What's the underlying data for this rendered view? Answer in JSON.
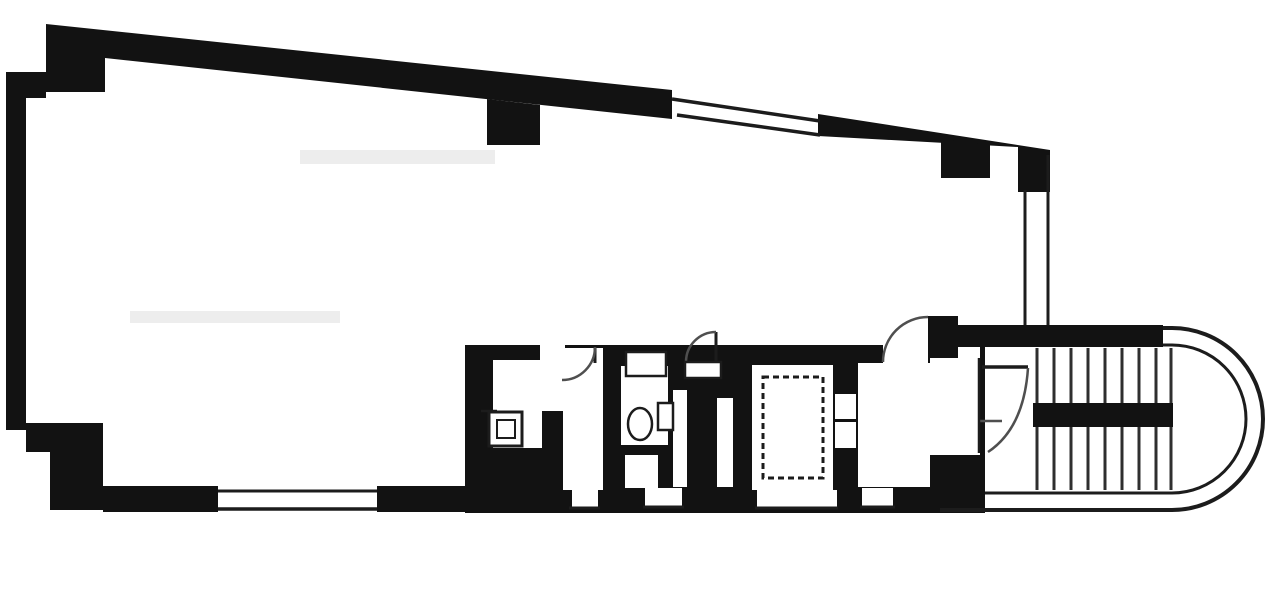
{
  "meta": {
    "description": "black-and-white architectural floor plan, single floor with large tapered office room, service core (pantry, WC, pipe shafts), elevator shaft and stairwell with rounded end",
    "canvas": {
      "width": 1280,
      "height": 595
    }
  },
  "colors": {
    "paper": "#ffffff",
    "ink": "#121212",
    "thin": "#1c1c1c",
    "step": "#2f2f2f",
    "arc": "#4f4f4f",
    "smudge": "#ededed"
  },
  "stairs": {
    "step_xs": [
      1037,
      1054,
      1071,
      1088,
      1105,
      1122,
      1139,
      1156,
      1171
    ],
    "step_y1": 348,
    "step_y2": 490,
    "step_width": 3
  },
  "shapes": [
    {
      "t": "rect",
      "name": "page-background",
      "x": 0,
      "y": 0,
      "w": 1280,
      "h": 595,
      "fill": "paper"
    },
    {
      "t": "rect",
      "name": "faint-smudge-upper",
      "x": 300,
      "y": 150,
      "w": 195,
      "h": 14,
      "fill": "smudge"
    },
    {
      "t": "rect",
      "name": "faint-smudge-lower",
      "x": 130,
      "y": 311,
      "w": 210,
      "h": 12,
      "fill": "smudge"
    },
    {
      "t": "poly",
      "name": "top-wall-left",
      "pts": [
        [
          46,
          24
        ],
        [
          672,
          90
        ],
        [
          672,
          119
        ],
        [
          105,
          58
        ],
        [
          105,
          92
        ],
        [
          46,
          92
        ]
      ],
      "fill": "ink"
    },
    {
      "t": "poly",
      "name": "top-wall-pier-left",
      "pts": [
        [
          487,
          99
        ],
        [
          540,
          105
        ],
        [
          540,
          145
        ],
        [
          487,
          145
        ]
      ],
      "fill": "ink"
    },
    {
      "t": "poly",
      "name": "top-wall-right",
      "pts": [
        [
          818,
          114
        ],
        [
          1050,
          150
        ],
        [
          1050,
          192
        ],
        [
          1018,
          192
        ],
        [
          1018,
          147
        ],
        [
          818,
          136
        ]
      ],
      "fill": "ink"
    },
    {
      "t": "poly",
      "name": "top-wall-pier-right",
      "pts": [
        [
          941,
          139
        ],
        [
          990,
          145
        ],
        [
          990,
          178
        ],
        [
          941,
          178
        ]
      ],
      "fill": "ink"
    },
    {
      "t": "poly",
      "name": "left-wall",
      "pts": [
        [
          6,
          72
        ],
        [
          26,
          72
        ],
        [
          26,
          430
        ],
        [
          6,
          430
        ]
      ],
      "fill": "ink"
    },
    {
      "t": "poly",
      "name": "left-wall-top-step",
      "pts": [
        [
          26,
          72
        ],
        [
          46,
          72
        ],
        [
          46,
          98
        ],
        [
          26,
          98
        ]
      ],
      "fill": "ink"
    },
    {
      "t": "poly",
      "name": "bottom-left-corner-step-a",
      "pts": [
        [
          26,
          423
        ],
        [
          103,
          423
        ],
        [
          103,
          452
        ],
        [
          26,
          452
        ]
      ],
      "fill": "ink"
    },
    {
      "t": "poly",
      "name": "bottom-left-corner-step-b",
      "pts": [
        [
          50,
          452
        ],
        [
          103,
          452
        ],
        [
          103,
          510
        ],
        [
          50,
          510
        ]
      ],
      "fill": "ink"
    },
    {
      "t": "poly",
      "name": "bottom-wall-left",
      "pts": [
        [
          103,
          486
        ],
        [
          218,
          486
        ],
        [
          218,
          512
        ],
        [
          103,
          512
        ]
      ],
      "fill": "ink"
    },
    {
      "t": "poly",
      "name": "bottom-wall-mid",
      "pts": [
        [
          377,
          486
        ],
        [
          466,
          486
        ],
        [
          466,
          512
        ],
        [
          377,
          512
        ]
      ],
      "fill": "ink"
    },
    {
      "t": "poly",
      "name": "service-core-walls",
      "pts": [
        [
          465,
          345
        ],
        [
          985,
          345
        ],
        [
          985,
          513
        ],
        [
          465,
          513
        ]
      ],
      "fill": "ink"
    },
    {
      "t": "poly",
      "name": "stairwell-top-wall",
      "pts": [
        [
          958,
          325
        ],
        [
          1163,
          325
        ],
        [
          1163,
          347
        ],
        [
          958,
          347
        ]
      ],
      "fill": "ink"
    },
    {
      "t": "poly",
      "name": "hall-door-stub-wall",
      "pts": [
        [
          928,
          316
        ],
        [
          958,
          316
        ],
        [
          958,
          358
        ],
        [
          928,
          358
        ]
      ],
      "fill": "ink"
    },
    {
      "t": "rect",
      "name": "pantry-room",
      "x": 493,
      "y": 360,
      "w": 49,
      "h": 88,
      "fill": "paper"
    },
    {
      "t": "rect",
      "name": "pantry-passage",
      "x": 540,
      "y": 345,
      "w": 25,
      "h": 66,
      "fill": "paper"
    },
    {
      "t": "rect",
      "name": "mid-room",
      "x": 563,
      "y": 348,
      "w": 40,
      "h": 142,
      "fill": "paper"
    },
    {
      "t": "rect",
      "name": "mid-room-window-notch",
      "x": 572,
      "y": 488,
      "w": 26,
      "h": 19,
      "fill": "paper"
    },
    {
      "t": "rect",
      "name": "wc-room",
      "x": 621,
      "y": 366,
      "w": 47,
      "h": 79,
      "fill": "paper"
    },
    {
      "t": "rect",
      "name": "wc-alcove",
      "x": 625,
      "y": 455,
      "w": 33,
      "h": 33,
      "fill": "paper"
    },
    {
      "t": "rect",
      "name": "wc-window-notch",
      "x": 645,
      "y": 488,
      "w": 37,
      "h": 19,
      "fill": "paper"
    },
    {
      "t": "rect",
      "name": "pipe-shaft-a",
      "x": 673,
      "y": 390,
      "w": 14,
      "h": 97,
      "fill": "paper"
    },
    {
      "t": "rect",
      "name": "pipe-shaft-b",
      "x": 717,
      "y": 398,
      "w": 16,
      "h": 89,
      "fill": "paper"
    },
    {
      "t": "rect",
      "name": "elevator-shaft",
      "x": 752,
      "y": 365,
      "w": 81,
      "h": 125,
      "fill": "paper"
    },
    {
      "t": "rect",
      "name": "under-shaft-window",
      "x": 757,
      "y": 490,
      "w": 80,
      "h": 17,
      "fill": "paper"
    },
    {
      "t": "rect",
      "name": "elevator-door-notch-a",
      "x": 835,
      "y": 394,
      "w": 21,
      "h": 25,
      "fill": "paper"
    },
    {
      "t": "rect",
      "name": "elevator-door-notch-b",
      "x": 835,
      "y": 422,
      "w": 21,
      "h": 26,
      "fill": "paper"
    },
    {
      "t": "rect",
      "name": "elevator-hall",
      "x": 858,
      "y": 363,
      "w": 72,
      "h": 124,
      "fill": "paper"
    },
    {
      "t": "rect",
      "name": "hall-door-opening",
      "x": 883,
      "y": 345,
      "w": 45,
      "h": 19,
      "fill": "paper"
    },
    {
      "t": "rect",
      "name": "hall-window-notch",
      "x": 862,
      "y": 488,
      "w": 31,
      "h": 18,
      "fill": "paper"
    },
    {
      "t": "rect",
      "name": "stair-vestibule",
      "x": 930,
      "y": 358,
      "w": 50,
      "h": 97,
      "fill": "paper"
    },
    {
      "t": "rect",
      "name": "stair-vestibule-notch",
      "x": 958,
      "y": 347,
      "w": 22,
      "h": 12,
      "fill": "paper"
    },
    {
      "t": "steps",
      "name": "stair-treads"
    },
    {
      "t": "poly",
      "name": "stair-landing-bar",
      "pts": [
        [
          1033,
          403
        ],
        [
          1173,
          403
        ],
        [
          1173,
          427
        ],
        [
          1033,
          427
        ]
      ],
      "fill": "ink"
    },
    {
      "t": "line",
      "name": "top-window-outer-edge",
      "x1": 672,
      "y1": 99,
      "x2": 820,
      "y2": 121,
      "stroke": "thin",
      "w": 3.5
    },
    {
      "t": "line",
      "name": "top-window-inner-edge",
      "x1": 677,
      "y1": 115,
      "x2": 820,
      "y2": 135,
      "stroke": "thin",
      "w": 3.5
    },
    {
      "t": "line",
      "name": "bottom-window-inner-edge",
      "x1": 218,
      "y1": 491,
      "x2": 377,
      "y2": 491,
      "stroke": "thin",
      "w": 3
    },
    {
      "t": "line",
      "name": "bottom-window-outer-edge",
      "x1": 218,
      "y1": 509,
      "x2": 377,
      "y2": 509,
      "stroke": "thin",
      "w": 3.5
    },
    {
      "t": "line",
      "name": "east-glass-wall-inner",
      "x1": 1025,
      "y1": 190,
      "x2": 1025,
      "y2": 325,
      "stroke": "thin",
      "w": 3
    },
    {
      "t": "line",
      "name": "east-glass-wall-outer",
      "x1": 1048,
      "y1": 155,
      "x2": 1048,
      "y2": 325,
      "stroke": "thin",
      "w": 3
    },
    {
      "t": "line",
      "name": "under-shaft-sill",
      "x1": 755,
      "y1": 508,
      "x2": 838,
      "y2": 508,
      "stroke": "thin",
      "w": 3
    },
    {
      "t": "line",
      "name": "hall-sill",
      "x1": 860,
      "y1": 507,
      "x2": 895,
      "y2": 507,
      "stroke": "thin",
      "w": 3
    },
    {
      "t": "line",
      "name": "mid-room-sill",
      "x1": 569,
      "y1": 508,
      "x2": 600,
      "y2": 508,
      "stroke": "thin",
      "w": 3
    },
    {
      "t": "line",
      "name": "wc-sill",
      "x1": 643,
      "y1": 507,
      "x2": 684,
      "y2": 507,
      "stroke": "thin",
      "w": 3
    },
    {
      "t": "line",
      "name": "pantry-shelf-line",
      "x1": 481,
      "y1": 411,
      "x2": 497,
      "y2": 411,
      "stroke": "thin",
      "w": 2.5
    },
    {
      "t": "line",
      "name": "mid-room-door-leaf",
      "x1": 595,
      "y1": 347,
      "x2": 595,
      "y2": 363,
      "stroke": "thin",
      "w": 3
    },
    {
      "t": "line",
      "name": "basin-door-leaf",
      "x1": 716,
      "y1": 332,
      "x2": 716,
      "y2": 362,
      "stroke": "thin",
      "w": 3
    },
    {
      "t": "line",
      "name": "stair-door-leaf",
      "x1": 982,
      "y1": 367,
      "x2": 1028,
      "y2": 367,
      "stroke": "thin",
      "w": 3.5
    },
    {
      "t": "line",
      "name": "stair-door-tick",
      "x1": 980,
      "y1": 421,
      "x2": 1002,
      "y2": 421,
      "stroke": "arc",
      "w": 2.5
    },
    {
      "t": "line",
      "name": "stair-door-frame",
      "x1": 979,
      "y1": 358,
      "x2": 979,
      "y2": 453,
      "stroke": "thin",
      "w": 2.5
    },
    {
      "t": "path",
      "name": "stairwell-outer-wall",
      "d": "M 1163 328 L 1172 328 A 91 91 0 0 1 1172 510 L 940 510",
      "stroke": "thin",
      "w": 4
    },
    {
      "t": "path",
      "name": "stairwell-inner-wall",
      "d": "M 1163 345 L 1172 345 A 74 74 0 0 1 1172 493 L 985 493",
      "stroke": "thin",
      "w": 3
    },
    {
      "t": "path",
      "name": "hall-door-swing-arc",
      "d": "M 883 362 A 45 45 0 0 1 928 317",
      "stroke": "arc",
      "w": 2.5
    },
    {
      "t": "path",
      "name": "stair-door-swing-arc",
      "d": "M 1028 368 Q 1024 428 988 452",
      "stroke": "arc",
      "w": 2.5
    },
    {
      "t": "path",
      "name": "mid-room-door-swing-arc",
      "d": "M 595 347 A 33 33 0 0 1 562 380",
      "stroke": "arc",
      "w": 2.5
    },
    {
      "t": "path",
      "name": "basin-swing-arc",
      "d": "M 686 362 A 30 30 0 0 1 716 332",
      "stroke": "arc",
      "w": 2.5
    },
    {
      "t": "path",
      "name": "elevator-cross-diagonal-a",
      "d": "M 766 380 L 820 475",
      "stroke": "thin",
      "w": 3,
      "dash": "6,4"
    },
    {
      "t": "path",
      "name": "elevator-cross-diagonal-b",
      "d": "M 820 380 L 766 475",
      "stroke": "thin",
      "w": 3,
      "dash": "6,4"
    },
    {
      "t": "orect",
      "name": "elevator-cage-outline",
      "x": 763,
      "y": 377,
      "w": 60,
      "h": 101,
      "sw": 3,
      "dash": "6,4"
    },
    {
      "t": "orect",
      "name": "pantry-sink-cabinet",
      "x": 489,
      "y": 412,
      "w": 33,
      "h": 34,
      "sw": 3
    },
    {
      "t": "orect",
      "name": "pantry-sink-basin",
      "x": 497,
      "y": 420,
      "w": 18,
      "h": 18,
      "sw": 2
    },
    {
      "t": "orect",
      "name": "wc-counter",
      "x": 626,
      "y": 352,
      "w": 40,
      "h": 24,
      "sw": 2.5
    },
    {
      "t": "orect",
      "name": "wc-cistern",
      "x": 658,
      "y": 403,
      "w": 15,
      "h": 27,
      "sw": 2.5
    },
    {
      "t": "orect",
      "name": "basin-pedestal",
      "x": 685,
      "y": 362,
      "w": 36,
      "h": 16,
      "sw": 2.5
    },
    {
      "t": "ellipse",
      "name": "wc-toilet-bowl",
      "cx": 640,
      "cy": 424,
      "rx": 12,
      "ry": 16,
      "sw": 2.5
    }
  ]
}
